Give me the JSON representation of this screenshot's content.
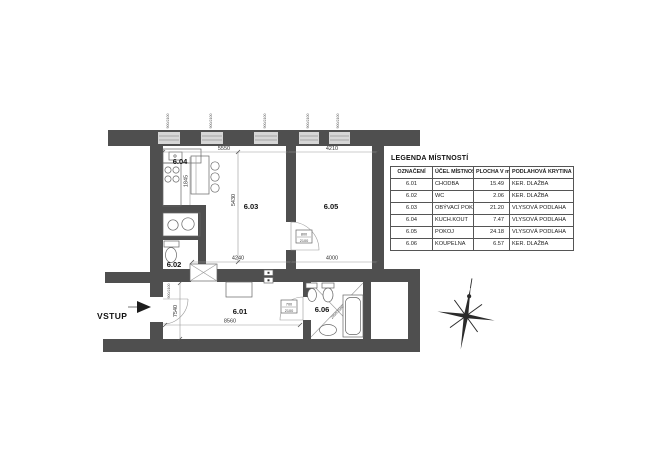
{
  "legend": {
    "title": "LEGENDA MÍSTNOSTÍ",
    "headers": [
      "OZNAČENÍ",
      "ÚČEL MÍSTNOSTI",
      "PLOCHA V m2",
      "PODLAHOVÁ KRYTINA"
    ],
    "rows": [
      {
        "id": "6.01",
        "name": "CHODBA",
        "area": "15.49",
        "floor": "KER. DLAŽBA"
      },
      {
        "id": "6.02",
        "name": "WC",
        "area": "2.06",
        "floor": "KER. DLAŽBA"
      },
      {
        "id": "6.03",
        "name": "OBÝVACÍ POKOJ",
        "area": "21.20",
        "floor": "VLYSOVÁ PODLAHA"
      },
      {
        "id": "6.04",
        "name": "KUCH.KOUT",
        "area": "7.47",
        "floor": "VLYSOVÁ PODLAHA"
      },
      {
        "id": "6.05",
        "name": "POKOJ",
        "area": "24.18",
        "floor": "VLYSOVÁ PODLAHA"
      },
      {
        "id": "6.06",
        "name": "KOUPELNA",
        "area": "6.57",
        "floor": "KER. DLAŽBA"
      }
    ]
  },
  "plan": {
    "entrance_label": "VSTUP",
    "room_labels": {
      "r601": "6.01",
      "r602": "6.02",
      "r603": "6.03",
      "r604": "6.04",
      "r605": "6.05",
      "r606": "6.06"
    },
    "dimensions": {
      "top_left": "5550",
      "top_right": "4210",
      "living_height": "5430",
      "kitchen_depth": "1845",
      "mid_left": "4240",
      "mid_right": "4000",
      "corridor_length": "8560",
      "corridor_height": "7540"
    },
    "doors": {
      "living": {
        "w": "800",
        "h": "2100"
      },
      "bathroom": {
        "w": "700",
        "h": "2100"
      },
      "entrance_label": "900/2100"
    },
    "window_label": "900/2100",
    "bath_diag_label": "2850/2580"
  },
  "colors": {
    "wall": "#4f4f4f",
    "line": "#999999",
    "text": "#1a1a1a"
  }
}
